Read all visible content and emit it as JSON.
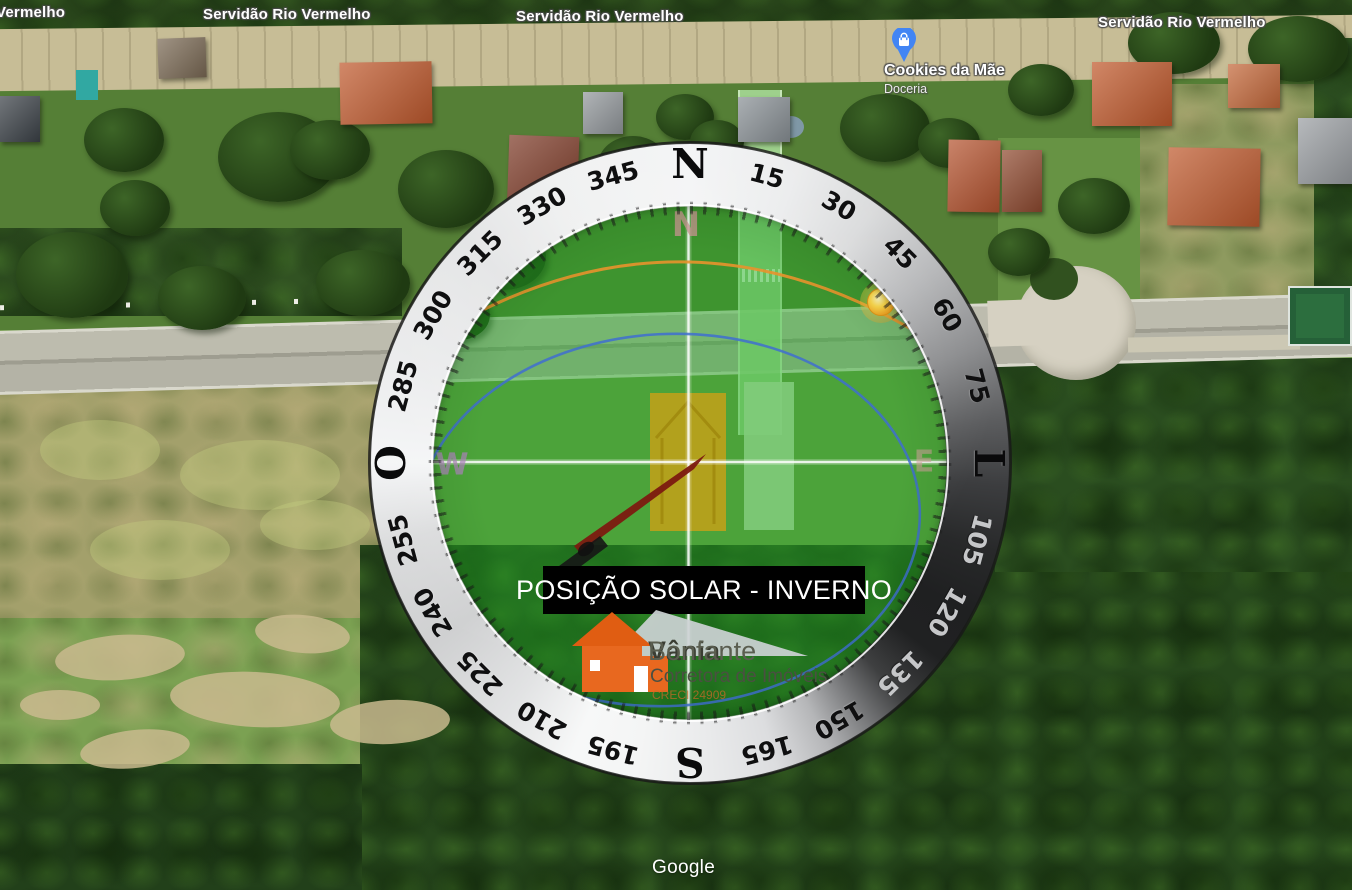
{
  "map": {
    "attribution": "Google",
    "street_labels": [
      {
        "text": "Vermelho",
        "x": -4,
        "y": 4
      },
      {
        "text": "Servidão Rio Vermelho",
        "x": 203,
        "y": 6
      },
      {
        "text": "Servidão Rio Vermelho",
        "x": 516,
        "y": 8
      },
      {
        "text": "Servidão Rio Vermelho",
        "x": 1098,
        "y": 14
      }
    ],
    "poi": {
      "name": "Cookies da Mãe",
      "category": "Doceria",
      "pin_color": "#4285f4"
    }
  },
  "compass": {
    "center_x": 690,
    "center_y": 463,
    "label_radius": 297,
    "ring_labels": [
      {
        "angle": 0,
        "text": "N",
        "cardinal": true
      },
      {
        "angle": 15,
        "text": "15"
      },
      {
        "angle": 30,
        "text": "30"
      },
      {
        "angle": 45,
        "text": "45"
      },
      {
        "angle": 60,
        "text": "60"
      },
      {
        "angle": 75,
        "text": "75"
      },
      {
        "angle": 90,
        "text": "L",
        "cardinal": true
      },
      {
        "angle": 105,
        "text": "105",
        "light": true
      },
      {
        "angle": 120,
        "text": "120",
        "light": true
      },
      {
        "angle": 135,
        "text": "135",
        "light": true
      },
      {
        "angle": 150,
        "text": "150"
      },
      {
        "angle": 165,
        "text": "165"
      },
      {
        "angle": 180,
        "text": "S",
        "cardinal": true
      },
      {
        "angle": 195,
        "text": "195"
      },
      {
        "angle": 210,
        "text": "210"
      },
      {
        "angle": 225,
        "text": "225"
      },
      {
        "angle": 240,
        "text": "240"
      },
      {
        "angle": 255,
        "text": "255"
      },
      {
        "angle": 270,
        "text": "O",
        "cardinal": true
      },
      {
        "angle": 285,
        "text": "285"
      },
      {
        "angle": 300,
        "text": "300"
      },
      {
        "angle": 315,
        "text": "315"
      },
      {
        "angle": 330,
        "text": "330"
      },
      {
        "angle": 345,
        "text": "345"
      }
    ],
    "watermarks": [
      {
        "text": "N",
        "x": 686,
        "y": 225,
        "color": "rgba(205,150,150,0.75)",
        "size": 34
      },
      {
        "text": "W",
        "x": 452,
        "y": 465,
        "color": "rgba(175,130,190,0.70)",
        "size": 30
      },
      {
        "text": "E",
        "x": 924,
        "y": 462,
        "color": "rgba(215,160,160,0.55)",
        "size": 30
      }
    ],
    "sun_color": "#ffcc33",
    "winter_path_color": "#e8922c",
    "summer_path_color": "#3f6ed0",
    "lot_highlight_color": "#c9a117"
  },
  "banner": {
    "text": "POSIÇÃO SOLAR - INVERNO",
    "bg": "#000000",
    "fg": "#ffffff"
  },
  "logo": {
    "name": "Vânia",
    "surname": "Bonfante",
    "tagline": "Corretora de Imóveis",
    "license": "CRECI 24909",
    "house_color": "#e8681f"
  }
}
